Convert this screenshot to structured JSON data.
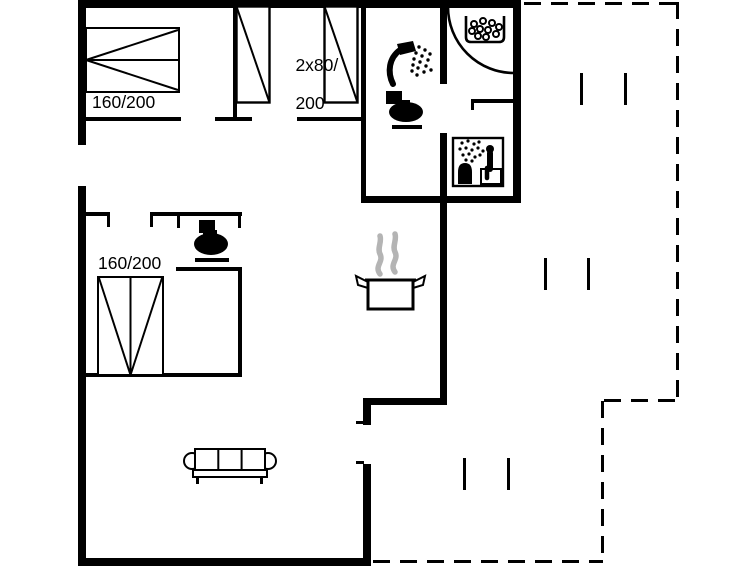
{
  "plan": {
    "type": "holiday-house floor plan",
    "labels": {
      "bed_double_top": "160/200",
      "beds_singles_line1": "2x80/",
      "beds_singles_line2": "200",
      "bed_double_left": "160/200"
    },
    "icons": [
      "double-bed-icon",
      "single-bed-icon",
      "shower-head-icon",
      "toilet-icon",
      "corner-shower-icon",
      "pebble-basin-icon",
      "sauna-icon",
      "steam-pot-icon",
      "sofa-icon",
      "window-marker",
      "terrace-outline"
    ],
    "colors": {
      "line": "#000000",
      "background": "#ffffff",
      "steam": "#b4b4b4"
    }
  }
}
